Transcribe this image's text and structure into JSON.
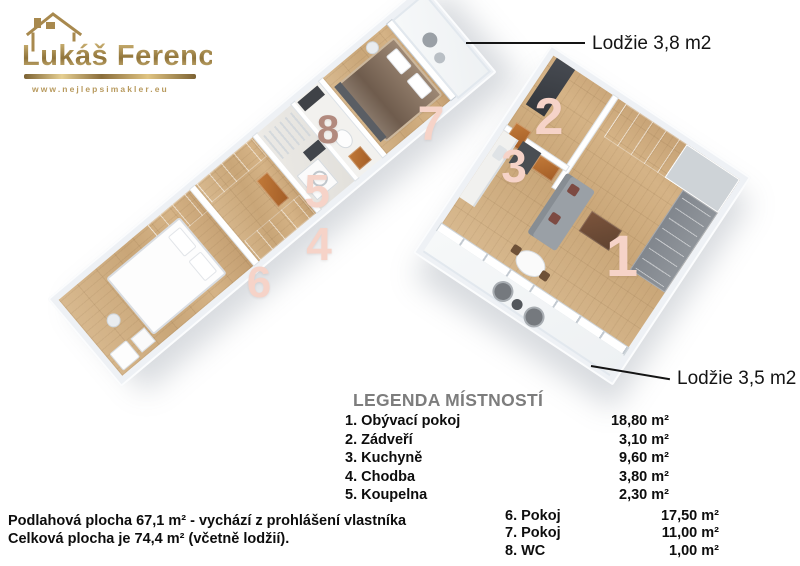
{
  "brand": {
    "name": "Lukáš Ferenc",
    "website": "www.nejlepsimakler.eu"
  },
  "callouts": {
    "balcony_top": "Lodžie 3,8 m2",
    "balcony_bottom": "Lodžie 3,5 m2"
  },
  "plan": {
    "numbers": [
      "1",
      "2",
      "3",
      "4",
      "5",
      "6",
      "7",
      "8"
    ]
  },
  "legend": {
    "title": "LEGENDA MÍSTNOSTÍ",
    "col1": [
      {
        "num": "1.",
        "name": "Obývací pokoj",
        "area": "18,80 m²"
      },
      {
        "num": "2.",
        "name": "Zádveří",
        "area": "3,10 m²"
      },
      {
        "num": "3.",
        "name": "Kuchyně",
        "area": "9,60 m²"
      },
      {
        "num": "4.",
        "name": "Chodba",
        "area": "3,80 m²"
      },
      {
        "num": "5.",
        "name": "Koupelna",
        "area": "2,30 m²"
      }
    ],
    "col2": [
      {
        "num": "6.",
        "name": "Pokoj",
        "area": "17,50 m²"
      },
      {
        "num": "7.",
        "name": "Pokoj",
        "area": "11,00 m²"
      },
      {
        "num": "8.",
        "name": "WC",
        "area": "1,00 m²"
      }
    ]
  },
  "footer": {
    "line1": "Podlahová plocha 67,1 m² - vychází z prohlášení vlastníka",
    "line2": "Celková plocha je 74,4 m² (včetně lodžií)."
  },
  "colors": {
    "gold": "#a8894e",
    "number_pink": "#f6d3c8",
    "number_dark": "#b28a7e",
    "wood": "#cfae85",
    "door_orange": "#b2692e",
    "feature_wall": "#3b3e43"
  }
}
